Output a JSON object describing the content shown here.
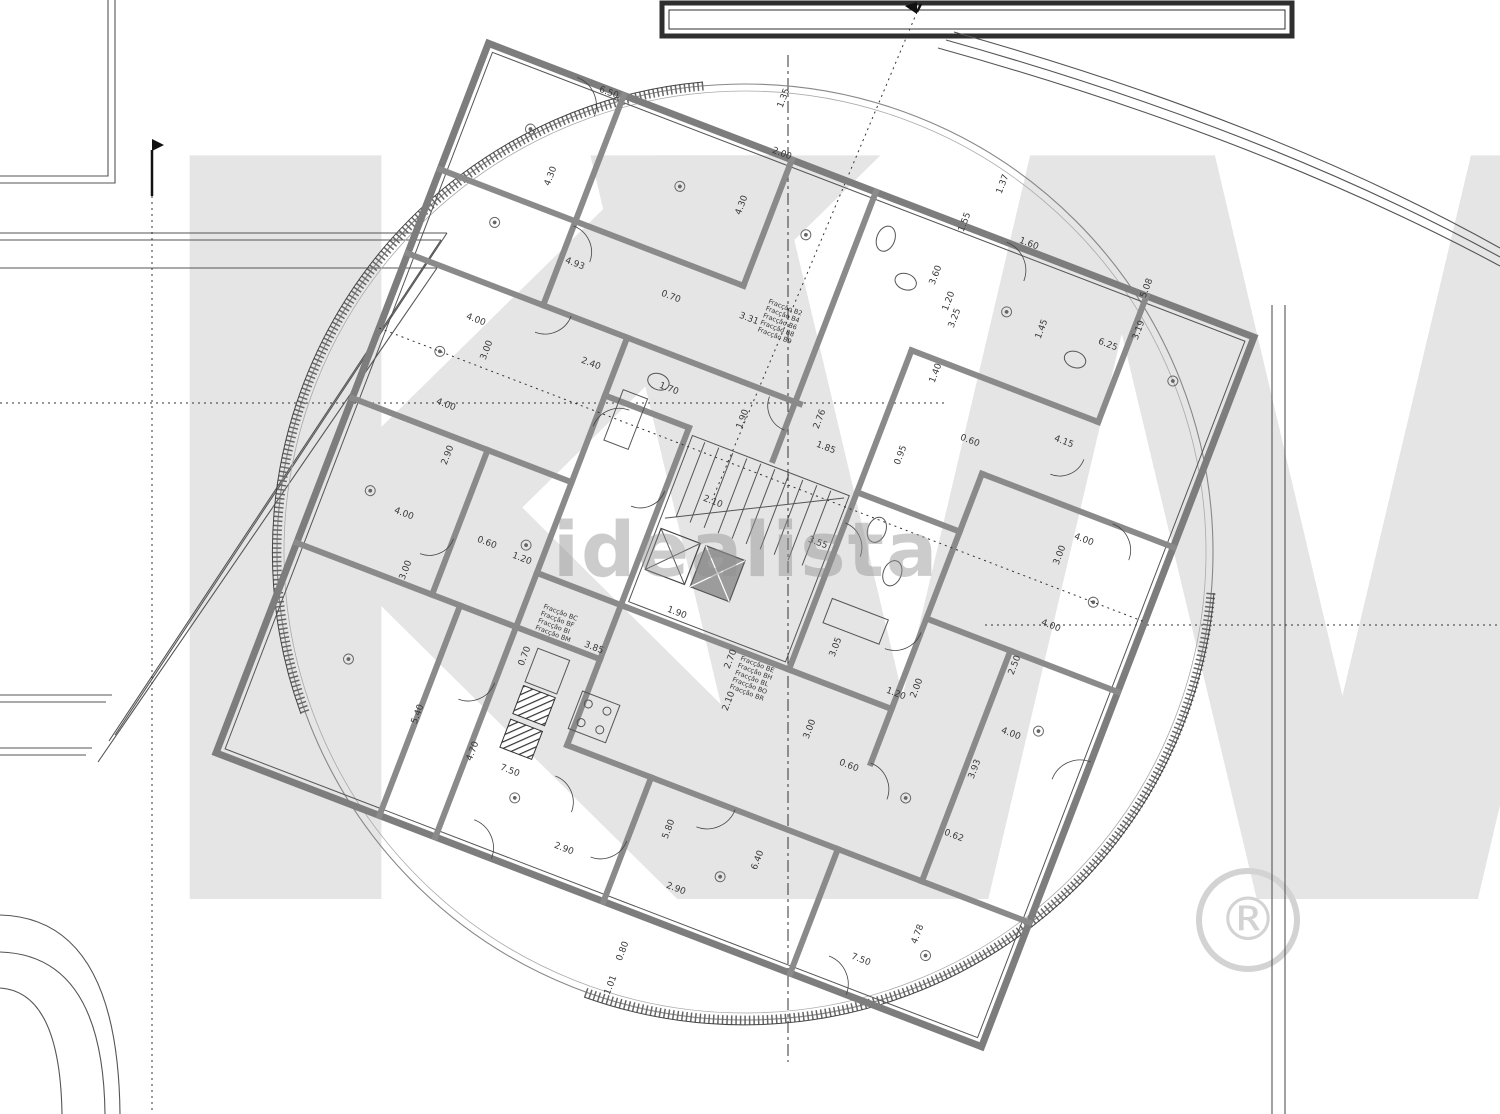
{
  "meta": {
    "drawing_type": "architectural floor plan",
    "units": "m"
  },
  "watermarks": {
    "brand_letter_k": "K",
    "brand_letter_w": "W",
    "registered_symbol": "®",
    "listing_watermark": "idealista"
  },
  "plan": {
    "fraction_blocks": [
      {
        "x": 768,
        "y": 303,
        "r": 21,
        "lines": [
          "Fracção B2",
          "Fracção B4",
          "Fracção B6",
          "Fracção B8",
          "Fracção B9"
        ]
      },
      {
        "x": 543,
        "y": 608,
        "r": 21,
        "lines": [
          "Fracção BC",
          "Fracção BF",
          "Fracção BI",
          "Fracção BM"
        ]
      },
      {
        "x": 740,
        "y": 660,
        "r": 21,
        "lines": [
          "Fracção BE",
          "Fracção BH",
          "Fracção BL",
          "Fracção BO",
          "Fracção BR"
        ]
      }
    ],
    "dimension_labels": [
      {
        "t": "6.50",
        "x": 608,
        "y": 95,
        "r": 21
      },
      {
        "t": "1.35",
        "x": 786,
        "y": 99,
        "r": -69
      },
      {
        "t": "4.30",
        "x": 553,
        "y": 177,
        "r": -69
      },
      {
        "t": "2.00",
        "x": 781,
        "y": 156,
        "r": 21
      },
      {
        "t": "4.30",
        "x": 744,
        "y": 206,
        "r": -69
      },
      {
        "t": "4.93",
        "x": 574,
        "y": 266,
        "r": 21
      },
      {
        "t": "0.70",
        "x": 670,
        "y": 299,
        "r": 21
      },
      {
        "t": "3.31",
        "x": 748,
        "y": 321,
        "r": 21
      },
      {
        "t": "1.37",
        "x": 1005,
        "y": 185,
        "r": -69
      },
      {
        "t": "1.55",
        "x": 967,
        "y": 223,
        "r": -69
      },
      {
        "t": "1.60",
        "x": 1028,
        "y": 246,
        "r": 21
      },
      {
        "t": "3.60",
        "x": 938,
        "y": 276,
        "r": -69
      },
      {
        "t": "1.20",
        "x": 951,
        "y": 302,
        "r": -69
      },
      {
        "t": "3.25",
        "x": 957,
        "y": 319,
        "r": -69
      },
      {
        "t": "5.08",
        "x": 1149,
        "y": 289,
        "r": -69
      },
      {
        "t": "3.19",
        "x": 1141,
        "y": 331,
        "r": -69
      },
      {
        "t": "6.25",
        "x": 1107,
        "y": 347,
        "r": 21
      },
      {
        "t": "1.45",
        "x": 1044,
        "y": 330,
        "r": -69
      },
      {
        "t": "1.40",
        "x": 938,
        "y": 374,
        "r": -69
      },
      {
        "t": "4.15",
        "x": 1063,
        "y": 444,
        "r": 21
      },
      {
        "t": "0.60",
        "x": 969,
        "y": 443,
        "r": 21
      },
      {
        "t": "4.00",
        "x": 475,
        "y": 322,
        "r": 21
      },
      {
        "t": "3.00",
        "x": 489,
        "y": 351,
        "r": -69
      },
      {
        "t": "2.40",
        "x": 590,
        "y": 366,
        "r": 21
      },
      {
        "t": "1.70",
        "x": 668,
        "y": 391,
        "r": 21
      },
      {
        "t": "4.00",
        "x": 445,
        "y": 407,
        "r": 21
      },
      {
        "t": "2.90",
        "x": 450,
        "y": 456,
        "r": -69
      },
      {
        "t": "4.00",
        "x": 403,
        "y": 516,
        "r": 21
      },
      {
        "t": "3.00",
        "x": 408,
        "y": 571,
        "r": -69
      },
      {
        "t": "0.60",
        "x": 486,
        "y": 545,
        "r": 21
      },
      {
        "t": "1.20",
        "x": 521,
        "y": 561,
        "r": 21
      },
      {
        "t": "1.90",
        "x": 745,
        "y": 420,
        "r": -69
      },
      {
        "t": "2.76",
        "x": 822,
        "y": 420,
        "r": -69
      },
      {
        "t": "1.85",
        "x": 825,
        "y": 450,
        "r": 21
      },
      {
        "t": "0.95",
        "x": 903,
        "y": 456,
        "r": -69
      },
      {
        "t": "2.10",
        "x": 712,
        "y": 504,
        "r": 21
      },
      {
        "t": "3.55",
        "x": 817,
        "y": 545,
        "r": 21
      },
      {
        "t": "1.90",
        "x": 676,
        "y": 615,
        "r": 21
      },
      {
        "t": "2.70",
        "x": 733,
        "y": 660,
        "r": -69
      },
      {
        "t": "2.10",
        "x": 731,
        "y": 702,
        "r": -69
      },
      {
        "t": "3.85",
        "x": 593,
        "y": 650,
        "r": 21
      },
      {
        "t": "0.70",
        "x": 527,
        "y": 657,
        "r": -69
      },
      {
        "t": "3.05",
        "x": 838,
        "y": 648,
        "r": -69
      },
      {
        "t": "2.00",
        "x": 919,
        "y": 689,
        "r": -69
      },
      {
        "t": "3.00",
        "x": 812,
        "y": 730,
        "r": -69
      },
      {
        "t": "4.00",
        "x": 1083,
        "y": 542,
        "r": 21
      },
      {
        "t": "3.00",
        "x": 1062,
        "y": 556,
        "r": -69
      },
      {
        "t": "4.00",
        "x": 1050,
        "y": 628,
        "r": 21
      },
      {
        "t": "2.50",
        "x": 1017,
        "y": 666,
        "r": -69
      },
      {
        "t": "4.00",
        "x": 1010,
        "y": 736,
        "r": 21
      },
      {
        "t": "3.93",
        "x": 977,
        "y": 770,
        "r": -69
      },
      {
        "t": "0.62",
        "x": 953,
        "y": 838,
        "r": 21
      },
      {
        "t": "4.78",
        "x": 920,
        "y": 935,
        "r": -69
      },
      {
        "t": "7.50",
        "x": 860,
        "y": 962,
        "r": 21
      },
      {
        "t": "5.40",
        "x": 420,
        "y": 715,
        "r": -69
      },
      {
        "t": "4.70",
        "x": 475,
        "y": 752,
        "r": -69
      },
      {
        "t": "7.50",
        "x": 509,
        "y": 773,
        "r": 21
      },
      {
        "t": "2.90",
        "x": 563,
        "y": 851,
        "r": 21
      },
      {
        "t": "5.80",
        "x": 671,
        "y": 830,
        "r": -69
      },
      {
        "t": "2.90",
        "x": 675,
        "y": 891,
        "r": 21
      },
      {
        "t": "6.40",
        "x": 760,
        "y": 861,
        "r": -69
      },
      {
        "t": "0.80",
        "x": 625,
        "y": 952,
        "r": -69
      },
      {
        "t": "1.01",
        "x": 613,
        "y": 986,
        "r": -69
      },
      {
        "t": "1.20",
        "x": 895,
        "y": 696,
        "r": 21
      },
      {
        "t": "0.60",
        "x": 848,
        "y": 768,
        "r": 21
      }
    ]
  }
}
